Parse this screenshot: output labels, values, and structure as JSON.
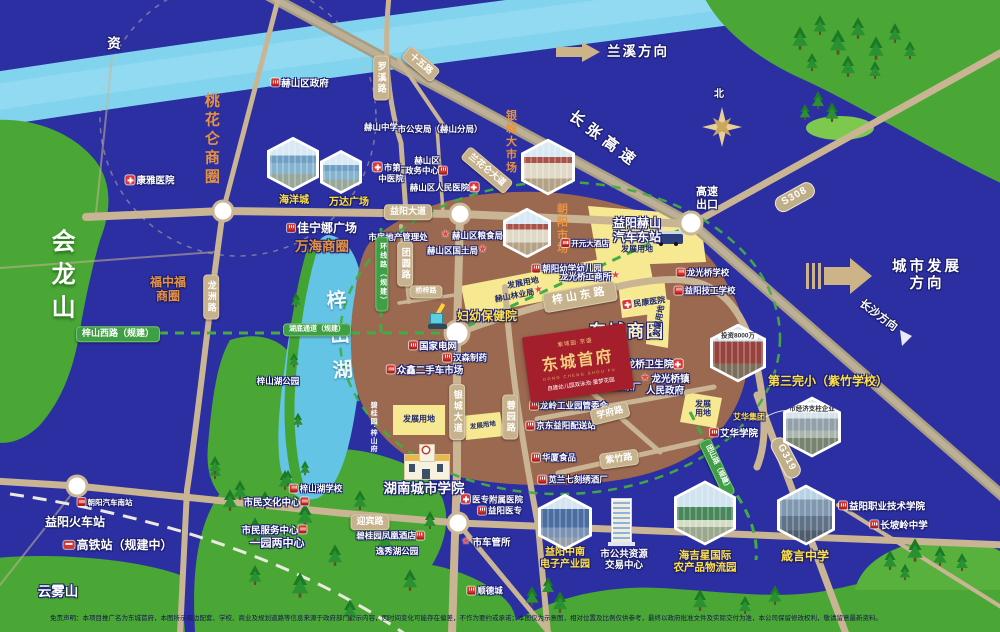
{
  "meta": {
    "title": "东城首府区位示意图",
    "compass": "北"
  },
  "logo": {
    "brand": "紫域园·京盛",
    "name": "东城首府",
    "pinyin": "DONG CHENG SHOU FU",
    "tagline": "自建幼儿园双泳池·童梦花园"
  },
  "disclaimer": "免责声明：本项目推广名为东城首府，本图所示周边配套、学校、商业及规划道路等信息来源于政府部门公示内容，因时间变化可能存在偏差，不作为要约或承诺；本图仅为示意图，相对位置及比例仅供参考，最终以政府批准文件及实际交付为准，本公司保留修改权利，敬请留意最新资料。",
  "hexagons": [
    {
      "id": "hex-haiyangcheng-photo",
      "x": 293,
      "y": 164,
      "s": 52,
      "k": "k-mall",
      "cap": ""
    },
    {
      "id": "hex-wanda-photo",
      "x": 341,
      "y": 172,
      "s": 42,
      "k": "k-mall",
      "cap": ""
    },
    {
      "id": "hex-yincheng-market-photo",
      "x": 548,
      "y": 167,
      "s": 54,
      "k": "k-market",
      "cap": ""
    },
    {
      "id": "hex-chaoyang-market-photo",
      "x": 527,
      "y": 233,
      "s": 48,
      "k": "k-market",
      "cap": ""
    },
    {
      "id": "hex-investment-photo",
      "x": 738,
      "y": 353,
      "s": 56,
      "k": "k-red",
      "cap": "投资8000万"
    },
    {
      "id": "hex-pillar-enterprise-photo",
      "x": 812,
      "y": 427,
      "s": 58,
      "k": "k-factory",
      "cap": "市经济支柱企业"
    },
    {
      "id": "hex-haijixing-photo",
      "x": 705,
      "y": 513,
      "s": 62,
      "k": "k-green",
      "cap": ""
    },
    {
      "id": "hex-zhenyan-photo",
      "x": 806,
      "y": 515,
      "s": 58,
      "k": "k-city",
      "cap": ""
    },
    {
      "id": "hex-zhongnan-photo",
      "x": 565,
      "y": 522,
      "s": 54,
      "k": "k-blue",
      "cap": ""
    }
  ],
  "features": [
    {
      "id": "river-name",
      "t": "资",
      "x": 114,
      "y": 44,
      "c": "w13 ol"
    },
    {
      "id": "mountain-huilongshan",
      "t": "会龙山",
      "x": 60,
      "y": 278,
      "c": "mountV"
    },
    {
      "id": "mountain-yunwushan",
      "t": "云雾山",
      "x": 58,
      "y": 592,
      "c": "w13 ol"
    },
    {
      "id": "lake-zishan",
      "t": "梓山湖",
      "x": 337,
      "y": 342,
      "c": "lakeV",
      "r": -5
    },
    {
      "id": "park-zishanhu",
      "t": "梓山湖公园",
      "x": 278,
      "y": 381,
      "c": "w8 ol"
    },
    {
      "id": "district-taohualun",
      "t": "桃花仑商圈",
      "x": 211,
      "y": 140,
      "c": "orV"
    },
    {
      "id": "district-wanhai",
      "t": "万海商圈",
      "x": 322,
      "y": 247,
      "c": "or13 ol"
    },
    {
      "id": "district-fuzhongfu",
      "t": "福中福\n商圈",
      "x": 168,
      "y": 289,
      "c": "or12 ol"
    },
    {
      "id": "district-dongcheng",
      "t": "东城商圈",
      "x": 627,
      "y": 332,
      "c": "big17 ol"
    },
    {
      "id": "market-yincheng",
      "t": "银城大市场",
      "x": 510,
      "y": 142,
      "c": "orV11"
    },
    {
      "id": "market-chaoyang",
      "t": "朝阳市场",
      "x": 561,
      "y": 229,
      "c": "orV11"
    },
    {
      "id": "poi-heshan-district-govt",
      "t": "赫山区政府",
      "x": 300,
      "y": 84,
      "c": "w9 ol",
      "i": "bldg"
    },
    {
      "id": "poi-kangya-hospital",
      "t": "康雅医院",
      "x": 150,
      "y": 181,
      "c": "w9 ol",
      "i": "cross"
    },
    {
      "id": "poi-haiyangcheng",
      "t": "海洋城",
      "x": 294,
      "y": 201,
      "c": "y10 ol"
    },
    {
      "id": "poi-wanda-plaza",
      "t": "万达广场",
      "x": 349,
      "y": 203,
      "c": "y10 ol"
    },
    {
      "id": "poi-jianingna-plaza",
      "t": "佳宁娜广场",
      "x": 322,
      "y": 228,
      "c": "w12 ol",
      "i": "bldg"
    },
    {
      "id": "poi-heshan-middle-school",
      "t": "赫山中学",
      "x": 381,
      "y": 127,
      "c": "w8 ol"
    },
    {
      "id": "poi-public-security",
      "t": "市公安局（赫山分局）",
      "x": 440,
      "y": 129,
      "c": "w8 ol"
    },
    {
      "id": "poi-first-tcm-hospital",
      "t": "市第一\n中医院",
      "x": 391,
      "y": 173,
      "c": "w8 ol",
      "i": "cross"
    },
    {
      "id": "poi-zhengwu-center",
      "t": "赫山区\n政务中心",
      "x": 427,
      "y": 166,
      "c": "w8 ol",
      "i": "bldg",
      "ip": "r"
    },
    {
      "id": "poi-renmin-hospital",
      "t": "赫山区人民医院",
      "x": 445,
      "y": 188,
      "c": "w8 ol",
      "i": "cross",
      "ip": "r"
    },
    {
      "id": "poi-real-estate-admin",
      "t": "市房地产管理处",
      "x": 398,
      "y": 237,
      "c": "w8 ol"
    },
    {
      "id": "poi-grain-bureau",
      "t": "赫山区粮食局",
      "x": 472,
      "y": 236,
      "c": "w8 ol",
      "i": "star"
    },
    {
      "id": "poi-land-bureau",
      "t": "赫山区国土局",
      "x": 458,
      "y": 251,
      "c": "w8 ol",
      "i": "star",
      "ip": "r"
    },
    {
      "id": "poi-kaiyuan-hotel",
      "t": "开元大酒店",
      "x": 585,
      "y": 244,
      "c": "w7 ol",
      "i": "bldg"
    },
    {
      "id": "poi-chaoyang-kindergarten",
      "t": "朝阳幼学幼儿园",
      "x": 567,
      "y": 269,
      "c": "w8 ol",
      "i": "bldg"
    },
    {
      "id": "poi-industry-office",
      "t": "龙光桥工商所",
      "x": 591,
      "y": 277,
      "c": "w8 ol",
      "i": "star",
      "ip": "r"
    },
    {
      "id": "plot-dev-northeast",
      "t": "发展用地",
      "x": 637,
      "y": 249,
      "c": "navy8"
    },
    {
      "id": "plot-dev-strip",
      "t": "发展用地",
      "x": 523,
      "y": 283,
      "c": "navy8",
      "r": -11
    },
    {
      "id": "poi-forestry-bureau",
      "t": "赫山林业局",
      "x": 520,
      "y": 295,
      "c": "navy8",
      "r": -11,
      "i": "star",
      "ip": "r"
    },
    {
      "id": "plot-dev-east",
      "t": "发展用地",
      "x": 659,
      "y": 321,
      "c": "navy8",
      "r": -80
    },
    {
      "id": "plot-dev-south1",
      "t": "发展用地",
      "x": 419,
      "y": 419,
      "c": "navy8"
    },
    {
      "id": "plot-dev-south2",
      "t": "发展用地",
      "x": 483,
      "y": 426,
      "c": "navy7",
      "r": -8
    },
    {
      "id": "plot-dev-southeast",
      "t": "发展\n用地",
      "x": 703,
      "y": 409,
      "c": "navy8"
    },
    {
      "id": "poi-minkang-hospital",
      "t": "民康医院",
      "x": 644,
      "y": 303,
      "c": "navy8",
      "r": -8,
      "i": "cross"
    },
    {
      "id": "poi-maternity-hospital",
      "t": "妇幼保健院",
      "x": 487,
      "y": 316,
      "c": "y12 ol"
    },
    {
      "id": "poi-state-grid",
      "t": "国家电网",
      "x": 433,
      "y": 347,
      "c": "w9 ol",
      "i": "bldg"
    },
    {
      "id": "poi-hansen-pharma",
      "t": "汉森制药",
      "x": 465,
      "y": 358,
      "c": "w8 ol",
      "i": "bldg"
    },
    {
      "id": "poi-used-car-market",
      "t": "众鑫二手车市场",
      "x": 425,
      "y": 371,
      "c": "w9 ol",
      "i": "bldg"
    },
    {
      "id": "poi-auto-east-station",
      "t": "益阳赫山\n汽车东站",
      "x": 637,
      "y": 230,
      "c": "w12 ol"
    },
    {
      "id": "poi-longqiao-clinic",
      "t": "龙桥卫生院",
      "x": 655,
      "y": 365,
      "c": "w9 ol",
      "i": "cross",
      "ip": "r"
    },
    {
      "id": "poi-longguangqiao-govt",
      "t": "龙光桥镇\n人民政府",
      "x": 665,
      "y": 385,
      "c": "w9 ol",
      "i": "star"
    },
    {
      "id": "poi-yiyang-tea-factory",
      "t": "益阳茶厂",
      "x": 619,
      "y": 387,
      "c": "w8 ol",
      "i": "bldg"
    },
    {
      "id": "poi-longling-industrial",
      "t": "龙岭工业园管委会",
      "x": 569,
      "y": 406,
      "c": "w8 ol",
      "i": "bldg"
    },
    {
      "id": "poi-jd-station",
      "t": "京东益阳配送站",
      "x": 561,
      "y": 426,
      "c": "w8 ol",
      "i": "bldg"
    },
    {
      "id": "poi-huaxia-food",
      "t": "华厦食品",
      "x": 554,
      "y": 458,
      "c": "w8 ol",
      "i": "bldg"
    },
    {
      "id": "poi-embroidery-winery",
      "t": "苋兰七刻绣酒厂",
      "x": 573,
      "y": 480,
      "c": "w8 ol",
      "i": "bldg"
    },
    {
      "id": "poi-longguangqiao-school",
      "t": "龙光桥学校",
      "x": 703,
      "y": 273,
      "c": "w8 ol",
      "i": "bldg"
    },
    {
      "id": "poi-technical-school",
      "t": "益阳技工学校",
      "x": 705,
      "y": 291,
      "c": "w8 ol",
      "i": "bldg"
    },
    {
      "id": "poi-aihua-college",
      "t": "艾华学院",
      "x": 734,
      "y": 434,
      "c": "w9 ol",
      "i": "bldg"
    },
    {
      "id": "poi-aihua-group",
      "t": "艾华集团",
      "x": 749,
      "y": 417,
      "c": "y8 ol"
    },
    {
      "id": "poi-no3-primary",
      "t": "第三完小（紫竹学校）",
      "x": 828,
      "y": 381,
      "c": "y12 ol"
    },
    {
      "id": "poi-vocational-college",
      "t": "益阳职业技术学院",
      "x": 882,
      "y": 507,
      "c": "w9 ol",
      "i": "bldg"
    },
    {
      "id": "poi-changpoling-school",
      "t": "长坡岭中学",
      "x": 899,
      "y": 526,
      "c": "w9 ol",
      "i": "bldg"
    },
    {
      "id": "label-haijixing",
      "t": "海吉星国际\n农产品物流园",
      "x": 705,
      "y": 562,
      "c": "y11 ol"
    },
    {
      "id": "label-zhenyan-school",
      "t": "箴言中学",
      "x": 805,
      "y": 556,
      "c": "y12 ol"
    },
    {
      "id": "label-zhongnan-park",
      "t": "益阳中南\n电子产业园",
      "x": 565,
      "y": 559,
      "c": "y10 ol"
    },
    {
      "id": "poi-public-resource-center",
      "t": "市公共资源\n交易中心",
      "x": 624,
      "y": 560,
      "c": "w9 ol"
    },
    {
      "id": "poi-hunan-city-university",
      "t": "湖南城市学院",
      "x": 424,
      "y": 489,
      "c": "w13 ol"
    },
    {
      "id": "poi-yizhuan-hospital",
      "t": "医专附属医院",
      "x": 492,
      "y": 500,
      "c": "w8 ol",
      "i": "cross"
    },
    {
      "id": "poi-yiyang-medical-college",
      "t": "益阳医专",
      "x": 500,
      "y": 511,
      "c": "w8 ol",
      "i": "bldg"
    },
    {
      "id": "poi-vehicle-admin",
      "t": "市车管所",
      "x": 486,
      "y": 543,
      "c": "w9 ol",
      "i": "star"
    },
    {
      "id": "poi-bgy-phoenix-hotel",
      "t": "碧桂园凤凰酒店",
      "x": 391,
      "y": 536,
      "c": "w8 ol",
      "i": "bldg",
      "ip": "r"
    },
    {
      "id": "poi-yixiuhu-park",
      "t": "逸秀湖公园",
      "x": 397,
      "y": 551,
      "c": "w8 ol"
    },
    {
      "id": "poi-shundecheng",
      "t": "顺德城",
      "x": 485,
      "y": 591,
      "c": "w8 ol",
      "i": "bldg"
    },
    {
      "id": "poi-bgy-zishanfu",
      "t": "碧桂园·梓山府",
      "x": 373,
      "y": 427,
      "c": "tinyV"
    },
    {
      "id": "poi-zishanhu-school",
      "t": "梓山湖学校",
      "x": 316,
      "y": 489,
      "c": "w8 ol",
      "i": "bldg"
    },
    {
      "id": "poi-citizen-culture-center",
      "t": "市民文化中心",
      "x": 277,
      "y": 503,
      "c": "w9 ol",
      "i": "bldg",
      "ip": "r"
    },
    {
      "id": "poi-citizen-service-center",
      "t": "市民服务中心",
      "x": 275,
      "y": 531,
      "c": "w9 ol",
      "i": "bldg",
      "ip": "r"
    },
    {
      "id": "poi-one-park-two-centers",
      "t": "一园两中心",
      "x": 277,
      "y": 544,
      "c": "w11 ol"
    },
    {
      "id": "poi-chaoyang-south-station",
      "t": "朝阳汽车南站",
      "x": 105,
      "y": 503,
      "c": "w7 ol",
      "i": "bldg"
    },
    {
      "id": "poi-yiyang-railway-station",
      "t": "益阳火车站",
      "x": 75,
      "y": 522,
      "c": "w12 ol"
    },
    {
      "id": "poi-hsr-station",
      "t": "高铁站（规建中）",
      "x": 118,
      "y": 545,
      "c": "w12 ol",
      "i": "train"
    },
    {
      "id": "dir-lanxi",
      "t": "兰溪方向",
      "x": 638,
      "y": 52,
      "c": "dir13 ol"
    },
    {
      "id": "dir-city-development",
      "t": "城市发展方向",
      "x": 927,
      "y": 276,
      "c": "dir14 ol"
    },
    {
      "id": "dir-changsha",
      "t": "长沙方向",
      "x": 878,
      "y": 316,
      "c": "w11 ol",
      "r": 37
    },
    {
      "id": "hwy-changzhang",
      "t": "长张高速",
      "x": 604,
      "y": 140,
      "c": "hwy ol",
      "r": 37
    },
    {
      "id": "compass-north-label",
      "t": "北",
      "x": 719,
      "y": 95,
      "c": "w10 ol"
    },
    {
      "id": "poi-expressway-exit",
      "t": "高速\n出口",
      "x": 707,
      "y": 199,
      "c": "w11 ol"
    },
    {
      "id": "road-yiyang-avenue",
      "t": "益阳大道",
      "x": 408,
      "y": 212,
      "c": "badge"
    },
    {
      "id": "road-luoxi",
      "t": "罗溪路",
      "x": 381,
      "y": 78,
      "c": "badge v"
    },
    {
      "id": "road-shiwu",
      "t": "十五路",
      "x": 421,
      "y": 64,
      "c": "badge",
      "r": 40
    },
    {
      "id": "road-longzhou",
      "t": "龙洲路",
      "x": 211,
      "y": 297,
      "c": "badge v"
    },
    {
      "id": "road-tuanyuan",
      "t": "团圆路",
      "x": 405,
      "y": 264,
      "c": "badge v"
    },
    {
      "id": "road-qiaozi",
      "t": "桥梓路",
      "x": 426,
      "y": 292,
      "c": "badge f7"
    },
    {
      "id": "road-huanxian-planned",
      "t": "环线路（规建）",
      "x": 382,
      "y": 274,
      "c": "badge gr v f7"
    },
    {
      "id": "road-zishan-west",
      "t": "梓山西路（规建）",
      "x": 118,
      "y": 334,
      "c": "badge gr"
    },
    {
      "id": "road-lake-tunnel",
      "t": "湖底通道（规建）",
      "x": 317,
      "y": 330,
      "c": "badge gr f7"
    },
    {
      "id": "road-zishan-east",
      "t": "梓山东路",
      "x": 580,
      "y": 297,
      "c": "badge f11",
      "r": -10
    },
    {
      "id": "road-lanhualun",
      "t": "兰花仑大道",
      "x": 487,
      "y": 170,
      "c": "badge",
      "r": 40
    },
    {
      "id": "road-yincheng-avenue",
      "t": "银城大道",
      "x": 457,
      "y": 412,
      "c": "badge v"
    },
    {
      "id": "road-rongyuan",
      "t": "蓉园路",
      "x": 510,
      "y": 417,
      "c": "badge v"
    },
    {
      "id": "road-fengshan",
      "t": "凤山路",
      "x": 578,
      "y": 376,
      "c": "badge",
      "r": 38
    },
    {
      "id": "road-xuefu",
      "t": "学府路",
      "x": 610,
      "y": 413,
      "c": "badge",
      "r": -14
    },
    {
      "id": "road-zizhu",
      "t": "紫竹路",
      "x": 619,
      "y": 459,
      "c": "badge",
      "r": -8
    },
    {
      "id": "road-yingbin",
      "t": "迎宾路",
      "x": 370,
      "y": 522,
      "c": "badge"
    },
    {
      "id": "road-tuanshan-planned",
      "t": "团山路（规建）",
      "x": 717,
      "y": 468,
      "c": "badge gr f7",
      "r": 65
    },
    {
      "id": "route-s308",
      "t": "S308",
      "x": 795,
      "y": 197,
      "c": "route",
      "r": -29
    },
    {
      "id": "route-g319",
      "t": "G319",
      "x": 786,
      "y": 458,
      "c": "route",
      "r": 62
    }
  ]
}
